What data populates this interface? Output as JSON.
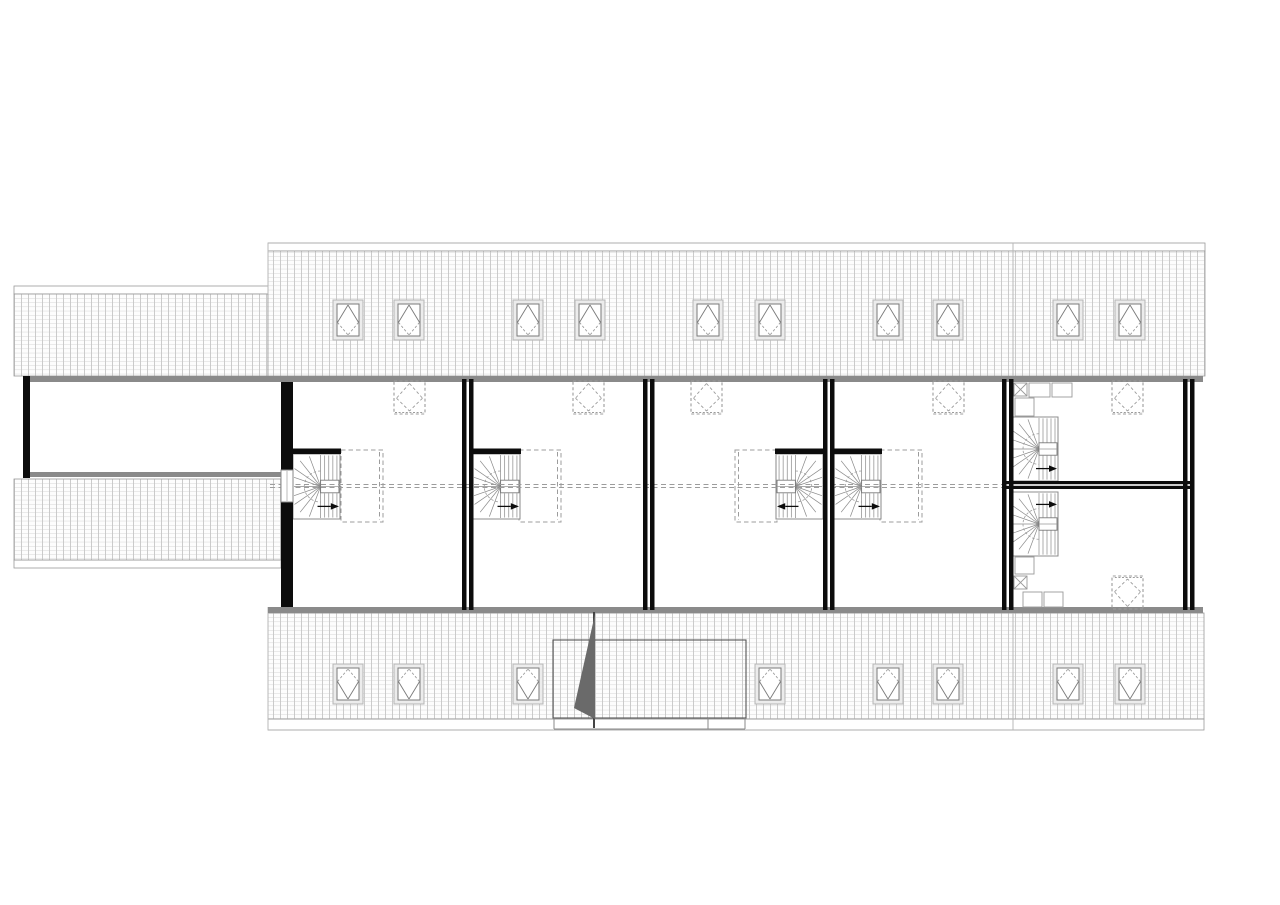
{
  "meta": {
    "drawing_type": "architectural attic / roof-level floor plan, monochrome CAD drawing",
    "text_labels": [],
    "background": "#ffffff"
  },
  "canvas": {
    "width": 1280,
    "height": 905
  },
  "colors": {
    "wall": "#0c0c0c",
    "gray_band": "#8a8a8a",
    "outline": "#9a9a9a",
    "hatch_line_v": "#c6c6c6",
    "hatch_line_h": "#cfcfcf",
    "hatch_bg": "#fdfdfd",
    "dashed": "#9c9c9c",
    "stair_line": "#8a8a8a",
    "window_frame_outer": "#b5b5b5",
    "window_frame_inner": "#7a7a7a",
    "canopy_line": "#555555",
    "triangle_fill": "#6a6a6a"
  },
  "roof": {
    "hatch_cell": {
      "w": 7,
      "h": 4.2
    },
    "bands": [
      {
        "id": "left-wing-north-roof",
        "x": 14,
        "y": 294,
        "w": 254,
        "h": 82
      },
      {
        "id": "main-north-roof",
        "x": 268,
        "y": 251,
        "w": 937,
        "h": 125
      },
      {
        "id": "left-wing-south-roof",
        "x": 14,
        "y": 479,
        "w": 267,
        "h": 81
      },
      {
        "id": "main-south-roof",
        "x": 268,
        "y": 613,
        "w": 936,
        "h": 106
      }
    ],
    "eaves": [
      {
        "id": "left-wing-north-eave",
        "x": 14,
        "y": 286,
        "w": 254,
        "h": 8
      },
      {
        "id": "main-north-eave",
        "x": 268,
        "y": 243,
        "w": 937,
        "h": 8
      },
      {
        "id": "left-wing-south-eave",
        "x": 14,
        "y": 560,
        "w": 267,
        "h": 8
      },
      {
        "id": "main-south-eave",
        "x": 268,
        "y": 719,
        "w": 936,
        "h": 11
      }
    ],
    "seams": [
      {
        "x1": 1013,
        "y1": 243,
        "x2": 1013,
        "y2": 376
      },
      {
        "x1": 1013,
        "y1": 613,
        "x2": 1013,
        "y2": 730
      },
      {
        "x1": 268,
        "y1": 243,
        "x2": 268,
        "y2": 294
      },
      {
        "x1": 268,
        "y1": 607,
        "x2": 268,
        "y2": 730
      }
    ]
  },
  "gray_bands": [
    {
      "id": "north-facade-band",
      "x": 23,
      "y": 376,
      "w": 1180,
      "h": 6
    },
    {
      "id": "left-corridor-band",
      "x": 30,
      "y": 472,
      "w": 252,
      "h": 5
    },
    {
      "id": "south-facade-band",
      "x": 268,
      "y": 607,
      "w": 935,
      "h": 6
    }
  ],
  "guide_line": {
    "x1": 270,
    "x2": 1002,
    "y": 484.5,
    "gap": 3
  },
  "dashed_boxes": [
    {
      "x": 341,
      "y": 450,
      "w": 42,
      "h": 72,
      "double_side": "right"
    },
    {
      "x": 519,
      "y": 450,
      "w": 42,
      "h": 72,
      "double_side": "right"
    },
    {
      "x": 735,
      "y": 450,
      "w": 42,
      "h": 72,
      "double_side": "left"
    },
    {
      "x": 880,
      "y": 450,
      "w": 42,
      "h": 72,
      "double_side": "right"
    }
  ],
  "stairs": [
    {
      "id": "stair-unit-1",
      "x": 293,
      "y": 454,
      "w": 47,
      "h": 65,
      "flip": "none",
      "bar": true
    },
    {
      "id": "stair-unit-2",
      "x": 473,
      "y": 454,
      "w": 47,
      "h": 65,
      "flip": "none",
      "bar": true
    },
    {
      "id": "stair-unit-3",
      "x": 776,
      "y": 454,
      "w": 47,
      "h": 65,
      "flip": "x",
      "bar": true
    },
    {
      "id": "stair-unit-4",
      "x": 834,
      "y": 454,
      "w": 47,
      "h": 65,
      "flip": "none",
      "bar": true
    },
    {
      "id": "stair-unit-5-upper",
      "x": 1012,
      "y": 417,
      "w": 46,
      "h": 64,
      "flip": "none",
      "bar": false
    },
    {
      "id": "stair-unit-5-lower",
      "x": 1012,
      "y": 492,
      "w": 46,
      "h": 64,
      "flip": "y",
      "bar": false
    }
  ],
  "walls": {
    "bar_w": 4.5,
    "gap": 2.5,
    "solid": [
      {
        "id": "left-wing-west-wall",
        "x": 23,
        "y": 376,
        "w": 7,
        "h": 102
      },
      {
        "id": "unit1-west-wall-top",
        "x": 281,
        "y": 382,
        "w": 12,
        "h": 88
      },
      {
        "id": "unit1-west-wall-bot",
        "x": 281,
        "y": 502,
        "w": 12,
        "h": 105
      }
    ],
    "double_vertical": [
      {
        "id": "party-wall-1-2",
        "x": 462,
        "y": 379,
        "h": 231
      },
      {
        "id": "party-wall-2-3",
        "x": 643,
        "y": 379,
        "h": 231
      },
      {
        "id": "party-wall-3-4",
        "x": 823,
        "y": 379,
        "h": 231
      },
      {
        "id": "party-wall-4-5",
        "x": 1002,
        "y": 379,
        "h": 231
      },
      {
        "id": "east-gable-wall",
        "x": 1183,
        "y": 379,
        "h": 231
      }
    ],
    "double_horizontal": [
      {
        "id": "unit5-cross-wall",
        "x": 1006,
        "y": 481,
        "w": 187
      }
    ]
  },
  "window_in_wall": {
    "id": "corridor-window",
    "x": 281,
    "y": 470,
    "w": 12,
    "h": 32
  },
  "roof_windows": {
    "size": {
      "w": 30,
      "h": 40
    },
    "top_row_y": 300,
    "top_xs": [
      333,
      394,
      513,
      575,
      693,
      755,
      873,
      933,
      1053,
      1115
    ],
    "bottom_row_y": 664,
    "bottom_xs": [
      333,
      394,
      513,
      755,
      873,
      933,
      1053,
      1115
    ]
  },
  "dashed_windows": {
    "size": {
      "w": 31,
      "h": 33
    },
    "top_row_y": 381,
    "top_xs": [
      394,
      573,
      691,
      933,
      1112
    ],
    "bottom": [
      {
        "x": 1112,
        "y": 576
      }
    ]
  },
  "furniture": [
    {
      "x": 1014,
      "y": 383,
      "w": 13,
      "h": 13,
      "x_mark": true
    },
    {
      "x": 1029,
      "y": 383,
      "w": 21,
      "h": 14,
      "x_mark": false
    },
    {
      "x": 1052,
      "y": 383,
      "w": 20,
      "h": 14,
      "x_mark": false
    },
    {
      "x": 1015,
      "y": 398,
      "w": 19,
      "h": 18,
      "x_mark": false
    },
    {
      "x": 1015,
      "y": 557,
      "w": 19,
      "h": 17,
      "x_mark": false
    },
    {
      "x": 1014,
      "y": 576,
      "w": 13,
      "h": 13,
      "x_mark": true
    },
    {
      "x": 1023,
      "y": 592,
      "w": 19,
      "h": 15,
      "x_mark": false
    },
    {
      "x": 1044,
      "y": 592,
      "w": 19,
      "h": 15,
      "x_mark": false
    }
  ],
  "entrance_canopy": {
    "rect": {
      "x": 553,
      "y": 640,
      "w": 193,
      "h": 78
    },
    "post_line": {
      "x": 594,
      "y1": 612,
      "y2": 728
    },
    "triangle": [
      [
        595,
        614
      ],
      [
        595,
        719
      ],
      [
        574,
        708
      ]
    ],
    "threshold": {
      "x1": 554,
      "x2": 745,
      "y_top": 718,
      "y_bot": 729
    },
    "inner_step_x": 708
  }
}
